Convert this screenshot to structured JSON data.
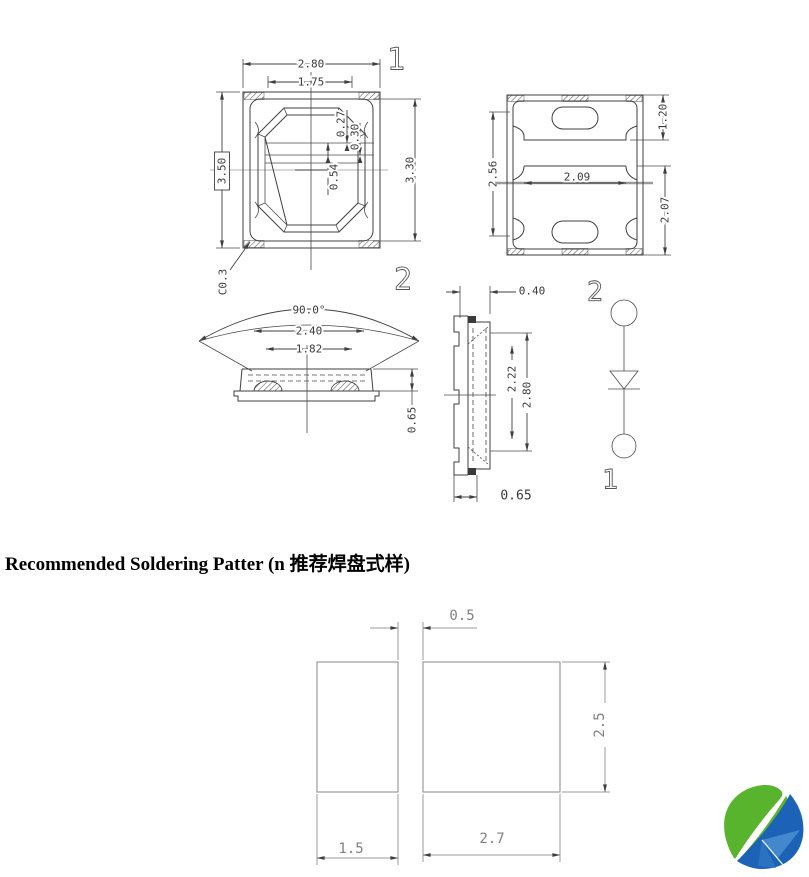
{
  "drawing": {
    "top_view": {
      "pin_label": "1",
      "dim_width": "2.80",
      "dim_inner_width": "1.75",
      "dim_height": "3.50",
      "dim_offset_a": "0.27",
      "dim_offset_b": "0.30",
      "dim_center": "0.54",
      "dim_side": "3.30",
      "chamfer_note": "C0.3"
    },
    "bottom_view": {
      "dim_pad_top": "1.20",
      "dim_left_span": "2.56",
      "dim_pad_width": "2.09",
      "dim_right_span": "2.07"
    },
    "side_view": {
      "pin_label": "2",
      "dim_angle": "90.0°",
      "dim_lens_outer": "2.40",
      "dim_lens_inner": "1.82",
      "dim_base_height": "0.65"
    },
    "profile_view": {
      "dim_tab": "0.40",
      "dim_height": "2.80",
      "dim_inner_height": "2.22",
      "dim_foot": "0.65"
    },
    "circuit": {
      "pin_top": "2",
      "pin_bottom": "1"
    }
  },
  "soldering": {
    "heading": "Recommended Soldering Patter (n 推荐焊盘式样)",
    "dim_gap": "0.5",
    "dim_height": "2.5",
    "dim_left_width": "1.5",
    "dim_right_width": "2.7"
  },
  "logo": {
    "green": "#58b42c",
    "blue": "#1c63b7"
  }
}
